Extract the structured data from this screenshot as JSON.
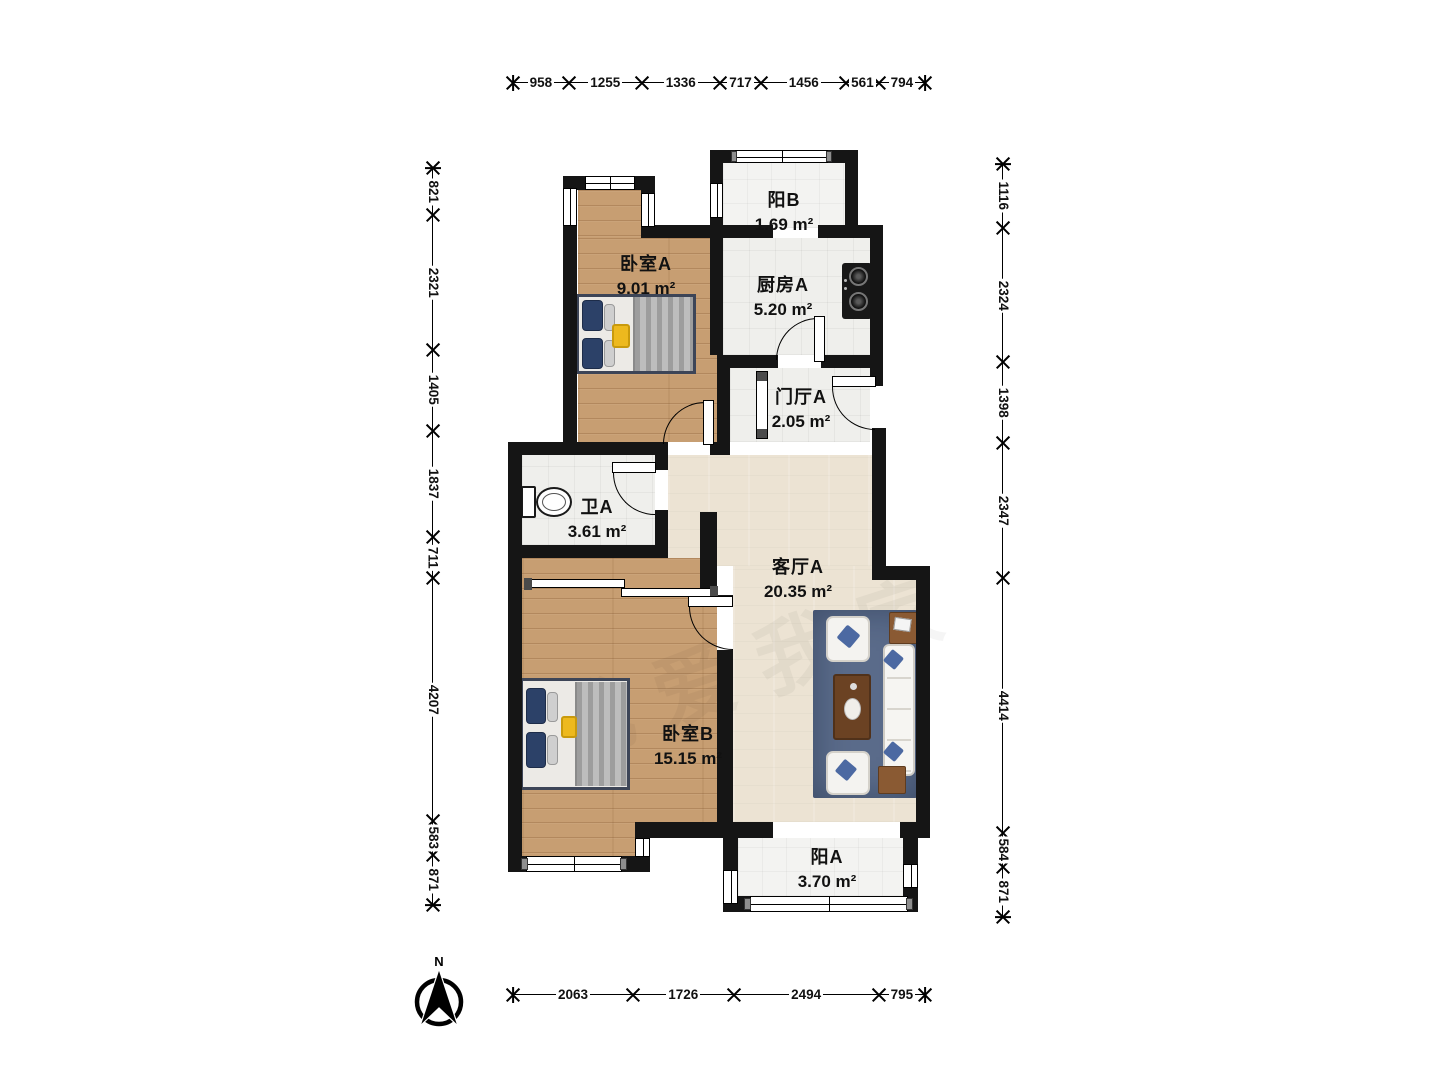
{
  "rooms": [
    {
      "name": "阳B",
      "area": "1.69 m²"
    },
    {
      "name": "卧室A",
      "area": "9.01 m²"
    },
    {
      "name": "厨房A",
      "area": "5.20 m²"
    },
    {
      "name": "门厅A",
      "area": "2.05 m²"
    },
    {
      "name": "卫A",
      "area": "3.61 m²"
    },
    {
      "name": "客厅A",
      "area": "20.35 m²"
    },
    {
      "name": "卧室B",
      "area": "15.15 m²"
    },
    {
      "name": "阳A",
      "area": "3.70 m²"
    }
  ],
  "dimensions": {
    "top": [
      958,
      1255,
      1336,
      717,
      1456,
      561,
      794
    ],
    "bottom": [
      2063,
      1726,
      2494,
      795
    ],
    "left": [
      821,
      2321,
      1405,
      1837,
      711,
      4207,
      583,
      871
    ],
    "right": [
      1116,
      2324,
      1398,
      2347,
      4414,
      584,
      871
    ]
  },
  "compass": {
    "label": "N"
  },
  "watermark": {
    "text": "我爱我家"
  },
  "colors": {
    "wall": "#151515",
    "wood_floor": "#c79e72",
    "living_floor": "#ece3d3",
    "tile_floor": "#efefec",
    "rug": "#5a6b8a",
    "pillow_accent": "#2c4168",
    "coffee_table": "#6b4223",
    "stove": "#181818",
    "tray_yellow": "#edb91e"
  }
}
